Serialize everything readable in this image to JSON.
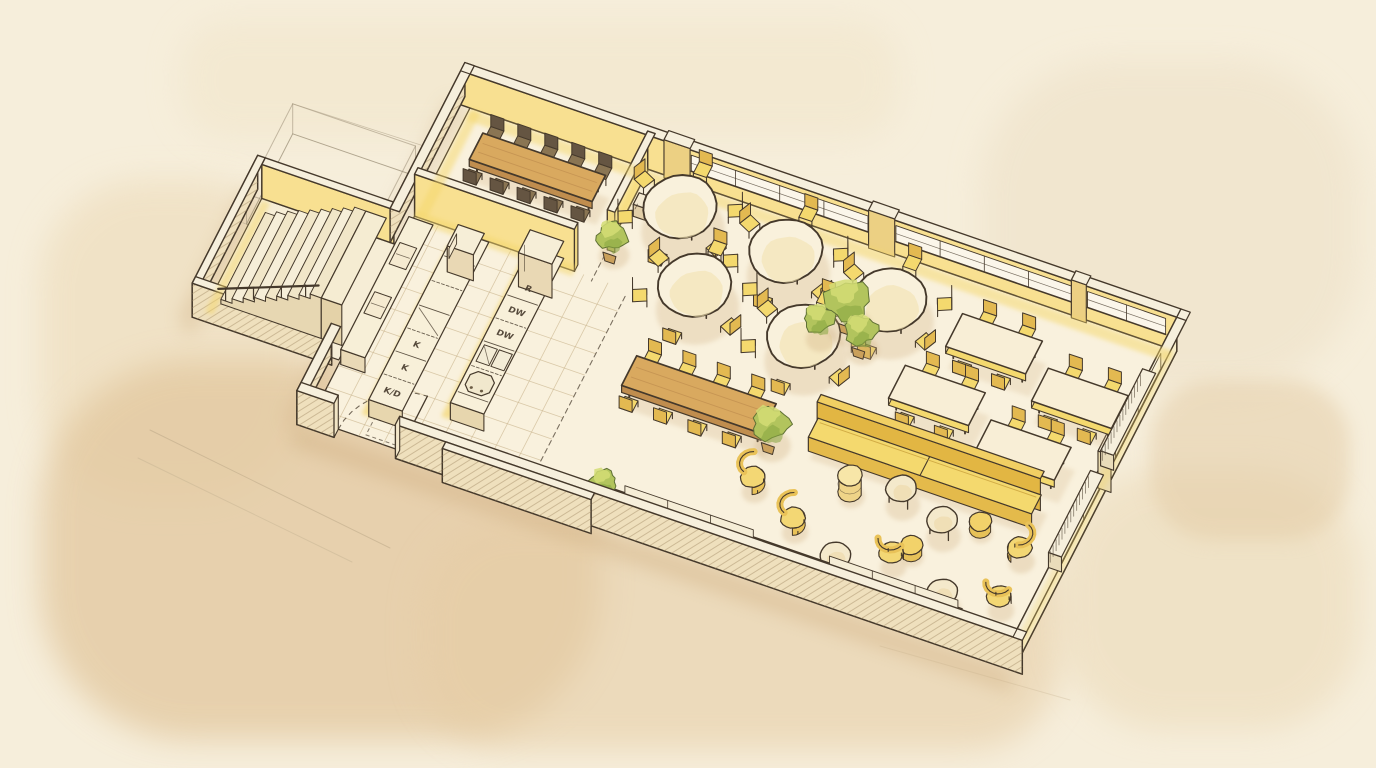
{
  "meta": {
    "title": "Hand-drawn isometric floor plan sketch of a restaurant interior",
    "style": "watercolor and ink sketch",
    "subject": "restaurant interior with open kitchen, dining areas, lounge and staircase"
  },
  "palette": {
    "paper": "#f6eedb",
    "wash_dark": "#e2c79e",
    "ink": "#45392b",
    "wall_face": "#f8e091",
    "wall_face_light": "#f9e8ab",
    "wall_top": "#f6efdc",
    "wall_outer": "#efe0bd",
    "floor": "#f9f1dd",
    "tile_line": "#c9b48d",
    "accent_yellow": "#f4d96e",
    "accent_yellow_dark": "#e3b951",
    "wood": "#d9a95f",
    "wood_dark": "#b8854a",
    "cream": "#f8eed6",
    "green": "#b2c45d",
    "green_light": "#d3dd74",
    "green_dark": "#87a63f",
    "shadow": "#cfae80"
  },
  "labels": {
    "island_left": [
      "K",
      "K",
      "K/D"
    ],
    "island_right": [
      "R",
      "DW",
      "DW"
    ]
  },
  "rooms": [
    {
      "name": "private-dining",
      "contents": "long wood table with 10 dark chairs"
    },
    {
      "name": "round-table-dining",
      "contents": "5 round tables with 6 chairs each"
    },
    {
      "name": "square-table-dining",
      "contents": "4 rectangular tables with 4 chairs each"
    },
    {
      "name": "open-kitchen",
      "contents": "2 counter islands, wall counter, tiled floor"
    },
    {
      "name": "communal-dining",
      "contents": "long wood table with 8 yellow chairs"
    },
    {
      "name": "lounge",
      "contents": "sofa, wall bench, 5 armchairs, 4 coffee tables, poufs"
    },
    {
      "name": "stairwell",
      "contents": "staircase with 9 steps and landing"
    },
    {
      "name": "unbuilt-annex",
      "contents": "pencil outline only"
    }
  ],
  "layout": {
    "iso": {
      "origin": [
        470,
        108
      ],
      "ex": [
        0.93,
        0.32
      ],
      "ey": [
        -0.42,
        0.82
      ],
      "wall_height": 34
    },
    "building": {
      "u": 760,
      "v": 380,
      "wall_thickness": 10
    },
    "annex": {
      "u1": -156,
      "v1": 168,
      "u2": -6,
      "v2": 316
    },
    "pencil_annex": {
      "u1": -150,
      "v1": 90,
      "u2": -18,
      "v2": 200,
      "height": 30
    },
    "stairs": {
      "u_bottom": -136,
      "tread": 12,
      "count": 9,
      "rise": 4.5,
      "v1": 186,
      "v2": 292,
      "landing": [
        -28,
        -6
      ]
    },
    "kitchen": {
      "tiles_u": [
        0,
        230
      ],
      "tiles_v": [
        132,
        380
      ],
      "step": 26,
      "island_left": {
        "u1": 52,
        "v1": 150,
        "u2": 88,
        "v2": 356,
        "h": 17,
        "divisions": [
          180,
          210,
          240,
          268,
          296,
          324
        ],
        "glass_cell": [
          240,
          268
        ],
        "label_cells": [
          282,
          310,
          340
        ]
      },
      "island_right": {
        "u1": 128,
        "v1": 140,
        "u2": 164,
        "v2": 330,
        "h": 17,
        "tall_cabinet": [
          140,
          168
        ],
        "divisions": [
          198,
          226,
          254,
          284,
          316
        ],
        "label_cells": [
          184,
          212,
          240
        ],
        "sink": [
          258,
          278
        ],
        "stove": [
          288,
          312
        ]
      },
      "wall_counter": {
        "u1": 2,
        "v1": 150,
        "u2": 28,
        "v2": 312,
        "h": 15,
        "appliances": [
          [
            180,
            206
          ],
          [
            240,
            266
          ]
        ]
      },
      "partition": {
        "u1": 0,
        "u2": 172,
        "v": 132,
        "h": 42
      },
      "door": {
        "gap": [
          30,
          96
        ],
        "radius": 66
      }
    },
    "private_room": {
      "partition_u": 192,
      "partition_v": [
        2,
        98
      ],
      "table": {
        "u1": 30,
        "v1": 36,
        "u2": 162,
        "v2": 68
      },
      "chair_us": [
        38,
        67,
        96,
        125,
        154
      ],
      "chair_vn": 26,
      "chair_vs": 78,
      "cart": [
        200,
        40,
        216,
        54
      ]
    },
    "round_tables": {
      "r": 36,
      "chair_dist": 54,
      "seats": 6,
      "centers": [
        [
          245,
          42
        ],
        [
          362,
          50
        ],
        [
          480,
          64
        ],
        [
          295,
          118
        ],
        [
          418,
          132
        ]
      ]
    },
    "rect_tables": {
      "w": 86,
      "d": 40,
      "centers": [
        [
          596,
          72
        ],
        [
          700,
          98
        ],
        [
          568,
          146
        ],
        [
          672,
          172
        ]
      ]
    },
    "communal_table": {
      "u1": 275,
      "v1": 212,
      "u2": 425,
      "v2": 248,
      "chair_us": [
        287,
        324,
        361,
        398
      ],
      "chair_vn": 202,
      "chair_vs": 258
    },
    "lounge": {
      "sofa": {
        "u1": 470,
        "v1": 205,
        "u2": 710,
        "v2": 235,
        "split": 590
      },
      "bench": {
        "u1": 310,
        "v1": 356,
        "u2": 690,
        "v2": 378
      },
      "armchairs": [
        [
          491,
          318,
          "W"
        ],
        [
          597,
          319,
          "S"
        ],
        [
          712,
          268,
          "E"
        ],
        [
          716,
          326,
          "S"
        ],
        [
          435,
          290,
          "W"
        ]
      ],
      "coffee_tables": {
        "r": 15,
        "centers": [
          [
            578,
            253
          ],
          [
            630,
            271
          ],
          [
            549,
            346
          ],
          [
            664,
            346
          ]
        ]
      },
      "poufs": {
        "r": 11,
        "centers": [
          [
            664,
            255
          ],
          [
            612,
            304
          ]
        ]
      },
      "cylinder_pouf": [
        527,
        262
      ]
    },
    "radiators": [
      [
        744,
        46,
        758,
        146
      ],
      [
        744,
        170,
        758,
        270
      ]
    ],
    "windows": {
      "north": [
        [
          238,
          428
        ],
        [
          458,
          648
        ],
        [
          664,
          748
        ]
      ],
      "east": [
        [
          38,
          146
        ],
        [
          168,
          276
        ]
      ],
      "south": [
        [
          340,
          478
        ],
        [
          560,
          698
        ]
      ]
    },
    "pilasters_north": [
      [
        210,
        238
      ],
      [
        430,
        458
      ],
      [
        648,
        664
      ]
    ],
    "plants": {
      "aisle_cluster": [
        [
          445,
          86,
          22
        ],
        [
          424,
          108,
          15
        ],
        [
          468,
          106,
          16
        ]
      ],
      "lounge_bush": [
        430,
        237,
        18
      ],
      "partition_bush": [
        196,
        96,
        15
      ],
      "bench_bush": [
        302,
        352,
        13
      ]
    },
    "dashes": [
      [
        [
          192,
          104
        ],
        [
          192,
          136
        ]
      ],
      [
        [
          230,
          140
        ],
        [
          230,
          374
        ]
      ]
    ],
    "dash_rect": [
      58,
      352,
      102,
      376
    ]
  }
}
